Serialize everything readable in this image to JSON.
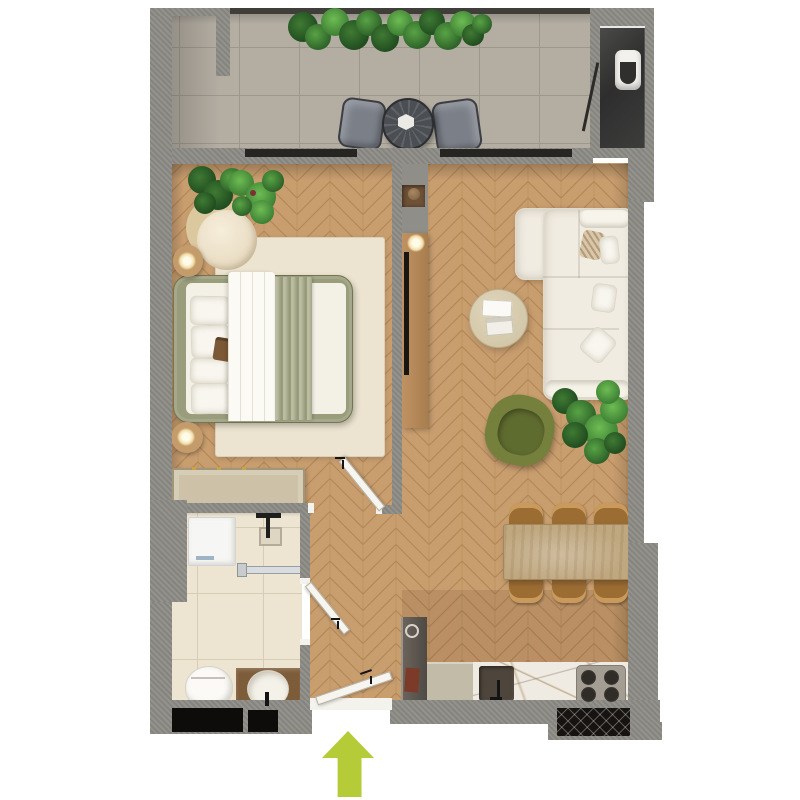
{
  "floor_plan": {
    "view": "top-down apartment render, no text labels",
    "colors": {
      "background": "#ffffff",
      "wall": "#8e8c86",
      "wood_floor": "#c99e6f",
      "balcony_tile": "#b3ada2",
      "bathroom_tile": "#ede5d2",
      "entrance_arrow": "#b6cb38",
      "bed_frame": "#9a9d7b",
      "bed_runner": "#a9ad8c",
      "sofa": "#f0ece1",
      "armchair_green": "#75803c",
      "dining_table_wood": "#bfa77f",
      "dining_chair": "#9c6d33",
      "rug": "#ece4d0",
      "wardrobe": "#cdc2a7",
      "counter_marble": "#efeae2",
      "glass_door": "#262521",
      "plant_green": "#3b7d33"
    },
    "entrance": {
      "symbol": "arrow-up",
      "meaning": "main entry direction"
    },
    "rooms": [
      {
        "id": "balcony",
        "floor": "tile",
        "furniture": [
          "railing-planter-plants",
          "bistro-table",
          "bistro-chair x2",
          "utility-niche-with-water-heater",
          "storage-door"
        ]
      },
      {
        "id": "bedroom",
        "floor": "herringbone-wood",
        "furniture": [
          "double-bed",
          "pillows x4",
          "throw-runner",
          "rug",
          "lounge-chair",
          "side-table-lamp x2",
          "wardrobe",
          "plants",
          "balcony-glass-door",
          "interior-door"
        ]
      },
      {
        "id": "living-room",
        "floor": "herringbone-wood",
        "furniture": [
          "corner-sofa",
          "sofa-pillows x4",
          "coffee-table-with-books",
          "tv-console",
          "tv",
          "wall-cabinet",
          "green-armchair",
          "plants",
          "dining-table",
          "dining-chair x6",
          "balcony-glass-door"
        ]
      },
      {
        "id": "kitchen",
        "floor": "herringbone-wood",
        "furniture": [
          "tall-cabinet",
          "counter",
          "marble-worktop",
          "sink-with-faucet",
          "cooktop-4-burners"
        ]
      },
      {
        "id": "bathroom",
        "floor": "cream-tile",
        "furniture": [
          "washing-machine",
          "shower-set",
          "shower-drain",
          "glass-screen",
          "toilet",
          "vanity-with-round-sink",
          "interior-door"
        ]
      },
      {
        "id": "hallway",
        "floor": "herringbone-wood",
        "furniture": [
          "entry-door",
          "threshold"
        ]
      }
    ],
    "counts": {
      "dining_chairs": 6,
      "bistro_chairs": 2,
      "bed_pillows": 4,
      "cooktop_burners": 4
    }
  }
}
